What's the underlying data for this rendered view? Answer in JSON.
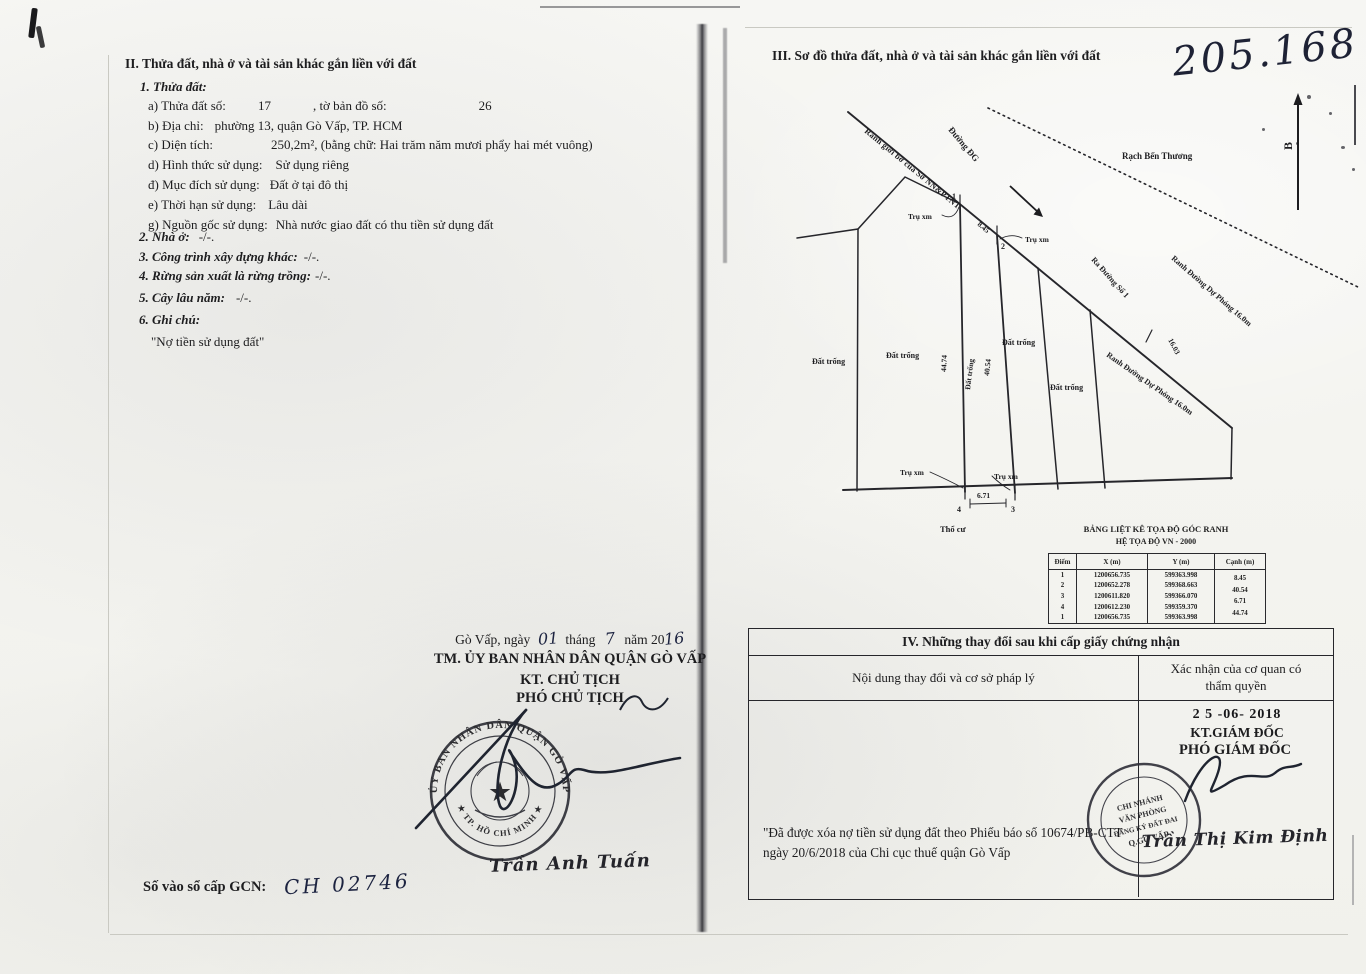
{
  "colors": {
    "ink": "#1d1d1f",
    "handwriting": "#1c2340",
    "paper": "#f6f6f3",
    "seal": "#2f3038"
  },
  "section_ii": {
    "heading": "II. Thửa đất, nhà ở và tài sản khác gắn liền với đất",
    "sub1_label": "1. Thửa đất:",
    "row_a": {
      "label": "a) Thửa đất số:",
      "value": "17",
      "label2": ", tờ bản đồ số:",
      "value2": "26"
    },
    "row_b": {
      "label": "b) Địa chỉ:",
      "value": "phường 13, quận Gò Vấp, TP. HCM"
    },
    "row_c": {
      "label": "c) Diện tích:",
      "value": "250,2m², (bằng chữ: Hai trăm năm mươi phẩy hai mét vuông)"
    },
    "row_d": {
      "label": "d) Hình thức sử dụng:",
      "value": "Sử dụng riêng"
    },
    "row_dd": {
      "label": "đ) Mục đích sử dụng:",
      "value": "Đất ở tại đô thị"
    },
    "row_e": {
      "label": "e) Thời hạn sử dụng:",
      "value": "Lâu dài"
    },
    "row_g": {
      "label": "g) Nguồn gốc sử dụng:",
      "value": "Nhà nước giao đất có thu tiền sử dụng đất"
    },
    "item2": {
      "label": "2. Nhà ở:",
      "value": "-/-."
    },
    "item3": {
      "label": "3. Công trình xây dựng khác:",
      "value": "-/-."
    },
    "item4": {
      "label": "4. Rừng sản xuất là rừng trồng:",
      "value": "-/-."
    },
    "item5": {
      "label": "5. Cây lâu năm:",
      "value": "-/-."
    },
    "item6": {
      "label": "6. Ghi chú:"
    },
    "note": "\"Nợ tiền sử dụng đất\""
  },
  "section_iii": {
    "heading": "III. Sơ đồ thửa đất, nhà ở và tài sản khác gắn liền với đất",
    "handwritten_number": "205.168",
    "map": {
      "north": "B",
      "duong_dg": "Đường ĐG",
      "rach": "Rạch Bến Thương",
      "ranh_gioi": "Ranh giới bờ của Sở NN&PTNT",
      "ranh_du_phong_dotted": "Ranh Đường Dự Phóng 16.0m",
      "ranh_du_phong_solid": "Ranh Đường Dự Phóng 16.0m",
      "ra_duong": "Ra Đường Số 1",
      "dim_16": "16.03",
      "dat_trong": "Đất trống",
      "tru_xm": "Trụ xm",
      "tho_cu": "Thổ cư",
      "edge_top": "8.45",
      "edge_left": "44.74",
      "edge_right": "40.54",
      "edge_bottom": "6.71",
      "p1": "1",
      "p2": "2",
      "p3": "3",
      "p4": "4"
    },
    "coord_table": {
      "title1": "BẢNG LIỆT KÊ TỌA ĐỘ GÓC RANH",
      "title2": "HỆ TỌA ĐỘ VN - 2000",
      "headers": [
        "Điểm",
        "X (m)",
        "Y (m)",
        "Cạnh (m)"
      ],
      "rows": [
        [
          "1",
          "1200656.735",
          "599363.998"
        ],
        [
          "2",
          "1200652.278",
          "599368.663"
        ],
        [
          "3",
          "1200611.820",
          "599366.070"
        ],
        [
          "4",
          "1200612.230",
          "599359.370"
        ],
        [
          "1",
          "1200656.735",
          "599363.998"
        ]
      ],
      "canh_values": [
        "8.45",
        "40.54",
        "6.71",
        "44.74"
      ]
    }
  },
  "signing": {
    "date_prefix": "Gò Vấp, ngày",
    "day": "01",
    "month_label": "tháng",
    "month": "7",
    "year_label": "năm 20",
    "year": "16",
    "authority": "TM. ỦY BAN NHÂN DÂN QUẬN GÒ VẤP",
    "title1": "KT. CHỦ TỊCH",
    "title2": "PHÓ CHỦ TỊCH",
    "signer_name": "Trần Anh Tuấn",
    "seal_arc_top": "ỦY BAN NHÂN DÂN QUẬN GÒ VẤP",
    "seal_arc_bottom": "★ TP. HỒ CHÍ MINH ★"
  },
  "registry": {
    "label": "Số vào sổ cấp GCN:",
    "value": "CH 02746"
  },
  "section_iv": {
    "heading": "IV. Những thay đổi sau khi cấp giấy chứng nhận",
    "col_left": "Nội dung thay đổi và cơ sở pháp lý",
    "col_right": "Xác nhận của cơ quan có thẩm quyền",
    "content": "\"Đã được xóa nợ tiền sử dụng đất theo Phiếu báo số 10674/PB-CTT ngày 20/6/2018 của Chi cục thuế quận Gò Vấp",
    "stamp_date": "2 5  -06-  2018",
    "title1": "KT.GIÁM ĐỐC",
    "title2": "PHÓ GIÁM ĐỐC",
    "signer_name": "Trần Thị Kim Định",
    "seal_lines": [
      "CHI NHÁNH",
      "VĂN PHÒNG",
      "ĐĂNG KÝ ĐẤT ĐAI",
      "Q.GÒ VẤP"
    ]
  }
}
